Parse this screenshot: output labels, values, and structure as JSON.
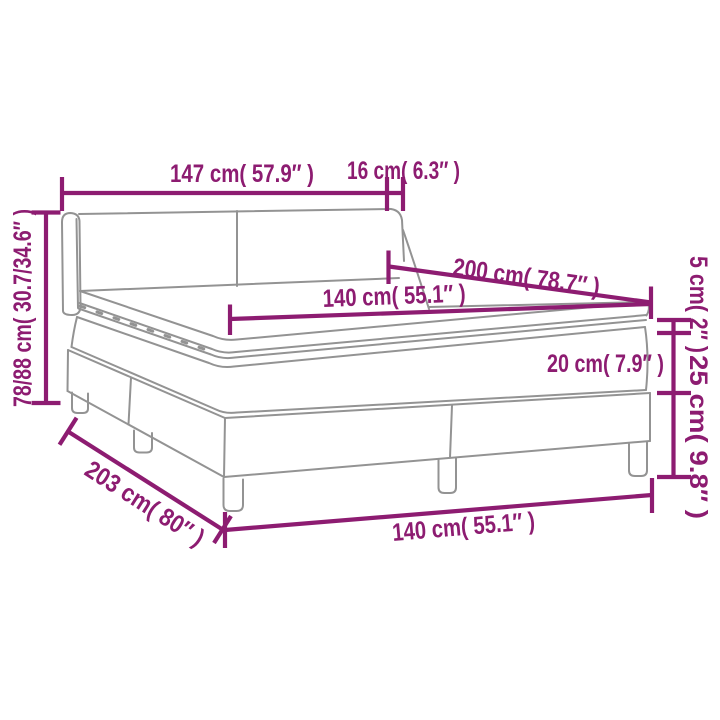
{
  "title": "Bed dimensions diagram",
  "subject": "Box spring bed with headboard, mattress and topper — outline drawing with measurements",
  "colors": {
    "dimension_lines": "#8d1c71",
    "bed_outline": "#939393",
    "background": "#ffffff"
  },
  "dimensions": [
    {
      "id": "headboard-width",
      "label": "147 cm( 57.9″ )",
      "cm": "147",
      "inches": "57.9"
    },
    {
      "id": "headboard-side-depth",
      "label": "16 cm( 6.3″ )",
      "cm": "16",
      "inches": "6.3"
    },
    {
      "id": "headboard-height",
      "label": "78/88 cm( 30.7/34.6″ )",
      "cm": "78/88",
      "inches": "30.7/34.6"
    },
    {
      "id": "mattress-length",
      "label": "200 cm( 78.7″ )",
      "cm": "200",
      "inches": "78.7"
    },
    {
      "id": "mattress-width",
      "label": "140 cm( 55.1″ )",
      "cm": "140",
      "inches": "55.1"
    },
    {
      "id": "topper-height",
      "label": "5 cm( 2″ )",
      "cm": "5",
      "inches": "2"
    },
    {
      "id": "mattress-height",
      "label": "20 cm( 7.9″ )",
      "cm": "20",
      "inches": "7.9"
    },
    {
      "id": "base-leg-height",
      "label": "25 cm( 9.8″ )",
      "cm": "25",
      "inches": "9.8"
    },
    {
      "id": "bed-length",
      "label": "203 cm( 80″ )",
      "cm": "203",
      "inches": "80"
    },
    {
      "id": "bed-width",
      "label": "140 cm( 55.1″ )",
      "cm": "140",
      "inches": "55.1"
    }
  ]
}
